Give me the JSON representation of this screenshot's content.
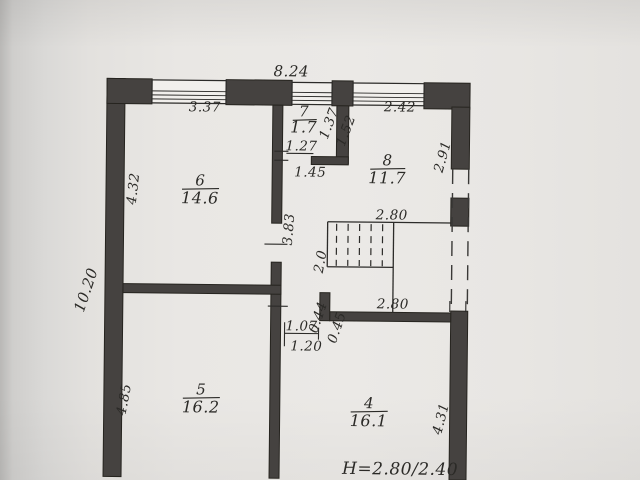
{
  "plan": {
    "height_note": "H=2.80/2.40",
    "rooms": {
      "r6": {
        "number": "6",
        "area": "14.6"
      },
      "r7": {
        "number": "7",
        "area": "1.7"
      },
      "r8": {
        "number": "8",
        "area": "11.7"
      },
      "r5": {
        "number": "5",
        "area": "16.2"
      },
      "r4": {
        "number": "4",
        "area": "16.1"
      }
    },
    "dims": {
      "top_total": "8.24",
      "room6_width": "3.37",
      "room8_width": "2.42",
      "room6_height": "4.32",
      "left_total": "10.20",
      "room5_height": "4.85",
      "room7_inner": "1.37",
      "room7_outer": "1.52",
      "door7_clear": "1.27",
      "door7_full": "1.45",
      "room8_height": "2.91",
      "hall_height": "3.83",
      "stair_top": "2.80",
      "stair_width": "2.0",
      "stair_bottom": "2.80",
      "jog_depth": "0.44",
      "jog_width": "0.45",
      "door4_clear": "1.07",
      "door4_full": "1.20",
      "room4_height": "4.31"
    },
    "colors": {
      "wall_fill": "#454240",
      "line": "#2c2b29",
      "paper": "#e9e7e4"
    }
  }
}
